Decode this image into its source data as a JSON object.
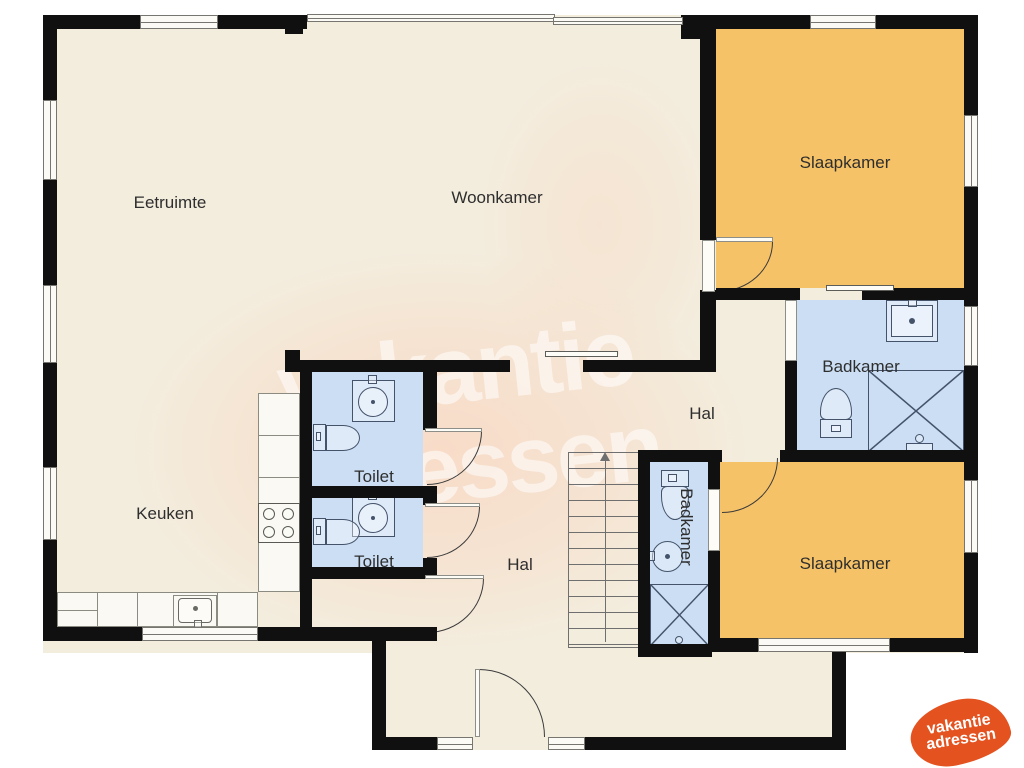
{
  "colors": {
    "floor": "#f3edde",
    "wall": "#101010",
    "room_orange": "#f6c268",
    "room_blue": "#cbdef4",
    "window_fill": "#fbfaf4",
    "frame": "#76756f",
    "fixture": "#44536a",
    "counter_line": "#8b8b82",
    "label": "#2e2e2e",
    "door": "#3a3a3a",
    "watermark_pink": "#f8dbc7",
    "watermark_text": "rgba(255,255,255,0.55)",
    "logo_orange": "#e4521f"
  },
  "rooms": [
    {
      "id": "eetruimte",
      "label": "Eetruimte"
    },
    {
      "id": "woonkamer",
      "label": "Woonkamer"
    },
    {
      "id": "slaapkamer-boven",
      "label": "Slaapkamer"
    },
    {
      "id": "badkamer-boven",
      "label": "Badkamer"
    },
    {
      "id": "hal-boven",
      "label": "Hal"
    },
    {
      "id": "toilet-1",
      "label": "Toilet"
    },
    {
      "id": "toilet-2",
      "label": "Toilet"
    },
    {
      "id": "keuken",
      "label": "Keuken"
    },
    {
      "id": "hal-beneden",
      "label": "Hal"
    },
    {
      "id": "badkamer-ensuite",
      "label": "Badkamer"
    },
    {
      "id": "slaapkamer-beneden",
      "label": "Slaapkamer"
    }
  ],
  "watermark": {
    "line1": "vakantie",
    "line2": "adressen"
  },
  "logo": {
    "line1": "vakantie",
    "line2": "adressen"
  }
}
